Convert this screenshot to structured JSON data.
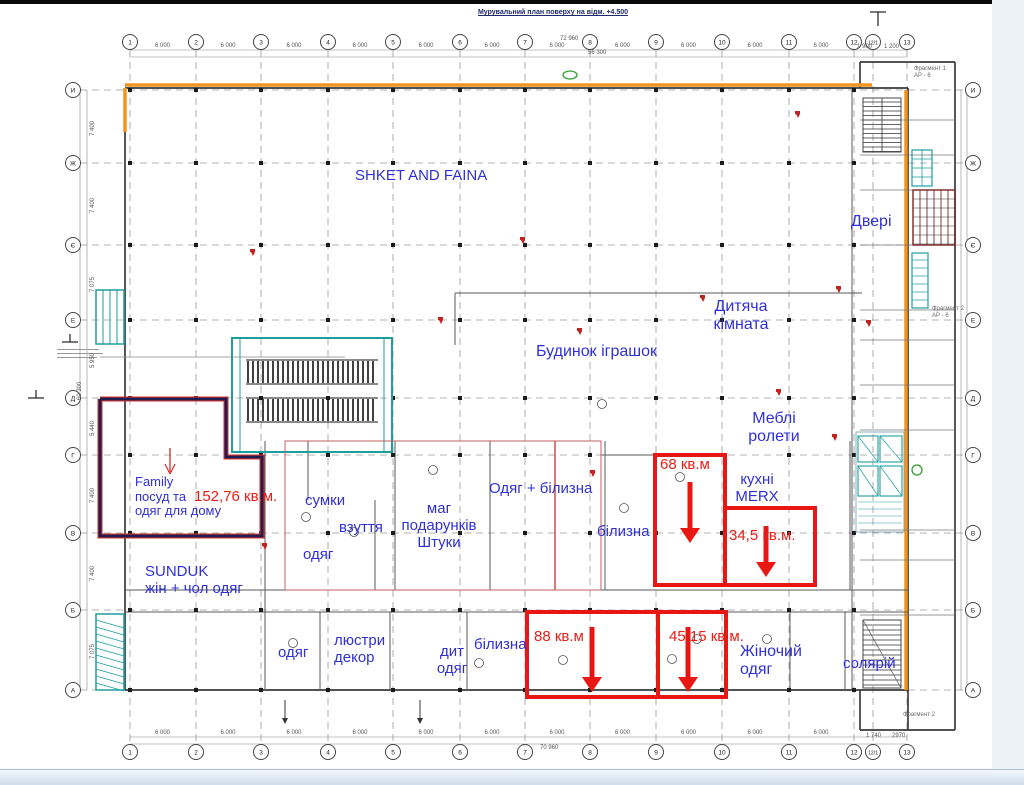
{
  "title": "Мурувальний план поверху на відм. +4.500",
  "colors": {
    "label_blue": "#3030d6",
    "annotation_red": "#e81e15",
    "wall_orange": "#f2951f",
    "stair_teal": "#1f9e9e",
    "family_outline_navy": "#1d1d52",
    "grid_gray": "#9a9a9a"
  },
  "grid": {
    "columns": [
      "1",
      "2",
      "3",
      "4",
      "5",
      "6",
      "7",
      "8",
      "9",
      "10",
      "11",
      "12",
      "12/1",
      "13"
    ],
    "rows": [
      "И",
      "Ж",
      "Є",
      "Е",
      "Д",
      "Г",
      "В",
      "Б",
      "А"
    ]
  },
  "dimensions": {
    "bay_top": "6 000",
    "top_total": "72 960",
    "top_sub": "56 300",
    "bottom_total": "70 960",
    "top_right": [
      "1 900",
      "1 200"
    ],
    "bottom_right": [
      "1 740",
      "2970"
    ],
    "left_bays": [
      "7 400",
      "7 400",
      "7 075",
      "5 950",
      "5 440",
      "7 400",
      "7 400",
      "7 075"
    ],
    "left_total": "60 300"
  },
  "labels": [
    {
      "id": "shket",
      "lines": [
        "SHKET AND FAINA"
      ],
      "color": "blue",
      "size": 15
    },
    {
      "id": "dveri",
      "lines": [
        "Двері"
      ],
      "color": "blue",
      "size": 16
    },
    {
      "id": "dytiacha-kimnata",
      "lines": [
        "Дитяча",
        "кімната"
      ],
      "color": "blue",
      "size": 16,
      "align": "center"
    },
    {
      "id": "budynok-igrashok",
      "lines": [
        "Будинок іграшок"
      ],
      "color": "blue",
      "size": 16
    },
    {
      "id": "mebli-rolety",
      "lines": [
        "Меблі",
        "ролети"
      ],
      "color": "blue",
      "size": 16,
      "align": "center"
    },
    {
      "id": "kuhni-merx",
      "lines": [
        "кухні",
        "MERX"
      ],
      "color": "blue",
      "size": 15,
      "align": "center"
    },
    {
      "id": "odyag-bilyzna",
      "lines": [
        "Одяг + білизна"
      ],
      "color": "blue",
      "size": 15
    },
    {
      "id": "bilyzna-mid",
      "lines": [
        "білизна"
      ],
      "color": "blue",
      "size": 15
    },
    {
      "id": "sumky",
      "lines": [
        "сумки"
      ],
      "color": "blue",
      "size": 15
    },
    {
      "id": "vzuttia",
      "lines": [
        "взуття"
      ],
      "color": "blue",
      "size": 15
    },
    {
      "id": "odyag-left",
      "lines": [
        "одяг"
      ],
      "color": "blue",
      "size": 15
    },
    {
      "id": "mag-podarunkiv",
      "lines": [
        "маг",
        "подарунків",
        "Штуки"
      ],
      "color": "blue",
      "size": 15,
      "align": "center"
    },
    {
      "id": "family",
      "lines": [
        "Family",
        "посуд та",
        "одяг для дому"
      ],
      "color": "blue",
      "size": 13
    },
    {
      "id": "area-152",
      "lines": [
        "152,76 кв.м."
      ],
      "color": "red",
      "size": 15
    },
    {
      "id": "sunduk",
      "lines": [
        "SUNDUK",
        "жін + чол одяг"
      ],
      "color": "blue",
      "size": 15
    },
    {
      "id": "odyag-bottom",
      "lines": [
        "одяг"
      ],
      "color": "blue",
      "size": 15
    },
    {
      "id": "liustry-dekor",
      "lines": [
        "люстри",
        "декор"
      ],
      "color": "blue",
      "size": 15
    },
    {
      "id": "dyt-odyag",
      "lines": [
        "дит",
        "одяг"
      ],
      "color": "blue",
      "size": 15,
      "align": "center"
    },
    {
      "id": "bilyzna-bottom",
      "lines": [
        "білизна"
      ],
      "color": "blue",
      "size": 15
    },
    {
      "id": "zhinochyi-odyag",
      "lines": [
        "Жіночий",
        "одяг"
      ],
      "color": "blue",
      "size": 16
    },
    {
      "id": "solarii",
      "lines": [
        "солярій"
      ],
      "color": "blue",
      "size": 15
    },
    {
      "id": "area-68",
      "lines": [
        "68 кв.м"
      ],
      "color": "red",
      "size": 15
    },
    {
      "id": "area-345",
      "lines": [
        "34,5 кв.м."
      ],
      "color": "red",
      "size": 15
    },
    {
      "id": "area-88",
      "lines": [
        "88 кв.м"
      ],
      "color": "red",
      "size": 15
    },
    {
      "id": "area-4515",
      "lines": [
        "45,15 кв.м."
      ],
      "color": "red",
      "size": 15
    },
    {
      "id": "fragment-1",
      "lines": [
        "Фрагмент 1",
        "АР - 6"
      ],
      "color": "gray",
      "size": 6
    },
    {
      "id": "fragment-2",
      "lines": [
        "Фрагмент 2",
        "АР - 6"
      ],
      "color": "gray",
      "size": 6
    },
    {
      "id": "fragment-3",
      "lines": [
        "Фрагмент 2"
      ],
      "color": "gray",
      "size": 6
    }
  ]
}
